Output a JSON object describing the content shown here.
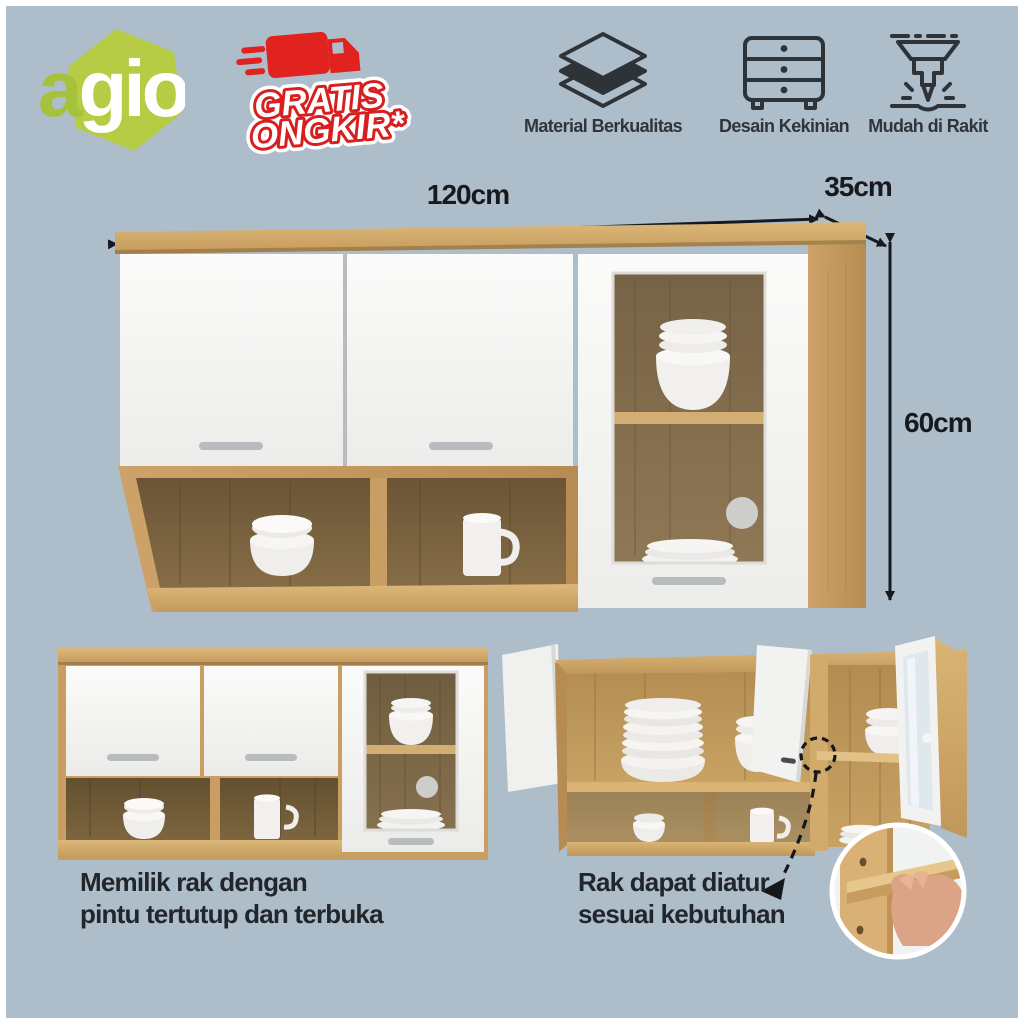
{
  "brand": {
    "prefix": "a",
    "suffix": "gio"
  },
  "badge": {
    "line1": "GRATIS",
    "line2": "ONGKIR*"
  },
  "features": [
    {
      "icon": "layers-icon",
      "label": "Material Berkualitas"
    },
    {
      "icon": "dresser-icon",
      "label": "Desain Kekinian"
    },
    {
      "icon": "drill-icon",
      "label": "Mudah di Rakit"
    }
  ],
  "dimensions": {
    "width_label": "120cm",
    "depth_label": "35cm",
    "height_label": "60cm"
  },
  "captions": {
    "left": {
      "line1": "Memilik rak dengan",
      "line2": "pintu tertutup dan terbuka"
    },
    "right": {
      "line1": "Rak dapat diatur",
      "line2": "sesuai kebutuhan"
    }
  },
  "colors": {
    "background": "#aebdca",
    "frame": "#ffffff",
    "badge_red": "#e1231f",
    "logo_green": "#b5cc44",
    "text_dark": "#21262c",
    "wood_light": "#d4ab6b",
    "wood_interior_dark": "#75603f",
    "door_white": "#f4f4f2"
  }
}
